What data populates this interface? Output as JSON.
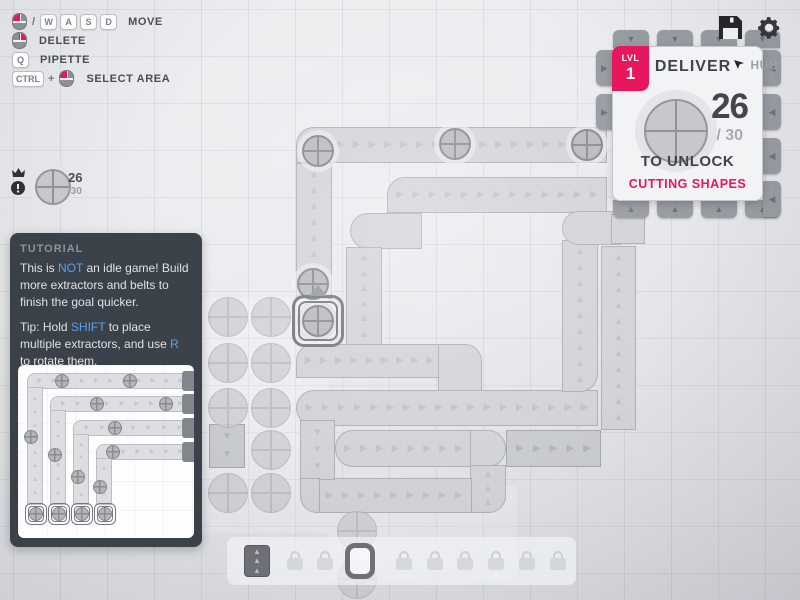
{
  "hud": {
    "keybinds": {
      "row1": {
        "sep": "/",
        "keys": [
          "W",
          "A",
          "S",
          "D"
        ],
        "label": "MOVE"
      },
      "row2": {
        "label": "DELETE"
      },
      "row3": {
        "key": "Q",
        "label": "PIPETTE"
      },
      "row4": {
        "key": "CTRL",
        "plus": "+",
        "label": "SELECT AREA"
      }
    },
    "pinned_goal": {
      "current": "26",
      "total": "/30"
    },
    "icons": [
      "save-icon",
      "gear-icon"
    ]
  },
  "hub": {
    "lvl_label": "LVL",
    "lvl": "1",
    "title": "DELIVER",
    "map_label": "HUB",
    "amount": "26",
    "goal": "/ 30",
    "unlock_line": "TO UNLOCK",
    "reward": "CUTTING SHAPES",
    "accent_color": "#e6175c",
    "shape": "circle"
  },
  "tutorial": {
    "title": "TUTORIAL",
    "p1": [
      {
        "t": "This is "
      },
      {
        "t": "NOT",
        "hl": true
      },
      {
        "t": " an idle game! Build more extractors and belts to finish the goal quicker."
      }
    ],
    "p2": [
      {
        "t": "Tip: Hold "
      },
      {
        "t": "SHIFT",
        "hl": true
      },
      {
        "t": " to place multiple extractors, and use "
      },
      {
        "t": "R",
        "hl": true
      },
      {
        "t": " to rotate them."
      }
    ],
    "diagram": {
      "extractors_x": [
        7,
        30,
        53,
        76
      ],
      "extractor_y": 138,
      "verticals_x": [
        9,
        32,
        55,
        78
      ],
      "horizontals_y": [
        8,
        31,
        55,
        79
      ],
      "belt_right_end": 166,
      "end_blocks_x": 164,
      "items": [
        [
          44,
          16
        ],
        [
          112,
          16
        ],
        [
          79,
          39
        ],
        [
          148,
          39
        ],
        [
          97,
          63
        ],
        [
          95,
          87
        ],
        [
          13,
          72
        ],
        [
          37,
          90
        ],
        [
          60,
          112
        ],
        [
          82,
          122
        ]
      ]
    }
  },
  "toolbar": {
    "slots": [
      {
        "type": "belt",
        "x": 242
      },
      {
        "type": "lock",
        "x": 280
      },
      {
        "type": "lock",
        "x": 310
      },
      {
        "type": "extractor",
        "x": 345,
        "selected": true
      },
      {
        "type": "lock",
        "x": 389
      },
      {
        "type": "lock",
        "x": 420
      },
      {
        "type": "lock",
        "x": 450
      },
      {
        "type": "lock",
        "x": 481
      },
      {
        "type": "lock",
        "x": 512
      },
      {
        "type": "lock",
        "x": 543
      }
    ]
  },
  "scene": {
    "chunks": [
      {
        "x": 188,
        "y": 298,
        "w": 141,
        "h": 235
      },
      {
        "x": 329,
        "y": 486,
        "w": 188,
        "h": 94
      }
    ],
    "belts": [
      {
        "x": 296,
        "y": 127,
        "w": 311,
        "h": 36,
        "dir": "right",
        "r": "18px 0 0 0"
      },
      {
        "x": 296,
        "y": 163,
        "w": 36,
        "h": 136,
        "dir": "up"
      },
      {
        "x": 387,
        "y": 177,
        "w": 220,
        "h": 36,
        "dir": "right",
        "r": "18px 0 0 0"
      },
      {
        "x": 350,
        "y": 213,
        "w": 72,
        "h": 36,
        "dir": "none",
        "r": "18px 0 0 18px"
      },
      {
        "x": 346,
        "y": 247,
        "w": 36,
        "h": 99,
        "dir": "up"
      },
      {
        "x": 296,
        "y": 344,
        "w": 162,
        "h": 34,
        "dir": "right",
        "r": "17px 0 0 0"
      },
      {
        "x": 438,
        "y": 344,
        "w": 44,
        "h": 82,
        "dir": "none",
        "r": "0 17px 17px 0"
      },
      {
        "x": 296,
        "y": 390,
        "w": 302,
        "h": 36,
        "dir": "right",
        "r": "18px 0 0 18px"
      },
      {
        "x": 562,
        "y": 240,
        "w": 36,
        "h": 152,
        "dir": "up",
        "r": "0 0 18px 0"
      },
      {
        "x": 562,
        "y": 211,
        "w": 60,
        "h": 34,
        "dir": "none",
        "r": "17px 0 0 17px"
      },
      {
        "x": 611,
        "y": 214,
        "w": 34,
        "h": 30,
        "dir": "none"
      },
      {
        "x": 601,
        "y": 246,
        "w": 35,
        "h": 184,
        "dir": "up"
      },
      {
        "x": 506,
        "y": 430,
        "w": 95,
        "h": 37,
        "dir": "right",
        "dark": true
      },
      {
        "x": 335,
        "y": 430,
        "w": 137,
        "h": 37,
        "dir": "right",
        "r": "18px 0 0 18px"
      },
      {
        "x": 470,
        "y": 430,
        "w": 36,
        "h": 37,
        "dir": "none",
        "r": "0 18px 18px 0"
      },
      {
        "x": 470,
        "y": 465,
        "w": 36,
        "h": 48,
        "dir": "up",
        "r": "0 0 17px 0"
      },
      {
        "x": 316,
        "y": 478,
        "w": 156,
        "h": 35,
        "dir": "right"
      },
      {
        "x": 300,
        "y": 420,
        "w": 35,
        "h": 60,
        "dir": "down"
      },
      {
        "x": 300,
        "y": 478,
        "w": 20,
        "h": 35,
        "dir": "none",
        "r": "0 0 0 17px"
      },
      {
        "x": 209,
        "y": 424,
        "w": 36,
        "h": 44,
        "dir": "down",
        "dark": true
      }
    ],
    "deposits": [
      [
        228,
        317
      ],
      [
        271,
        317
      ],
      [
        228,
        363
      ],
      [
        271,
        363
      ],
      [
        228,
        408
      ],
      [
        271,
        408
      ],
      [
        271,
        450
      ],
      [
        228,
        493
      ],
      [
        271,
        493
      ],
      [
        317,
        321
      ],
      [
        357,
        531
      ],
      [
        357,
        579
      ]
    ],
    "items": [
      [
        318,
        151
      ],
      [
        455,
        144
      ],
      [
        587,
        145
      ],
      [
        313,
        284
      ],
      [
        318,
        321
      ]
    ],
    "extractor": {
      "x": 292,
      "y": 295,
      "w": 52,
      "h": 52
    },
    "hub_tabs": [
      {
        "x": 613,
        "y": 30,
        "w": 36,
        "h": 18,
        "side": "top"
      },
      {
        "x": 657,
        "y": 30,
        "w": 36,
        "h": 18,
        "side": "top"
      },
      {
        "x": 701,
        "y": 30,
        "w": 36,
        "h": 18,
        "side": "top"
      },
      {
        "x": 745,
        "y": 30,
        "w": 35,
        "h": 18,
        "side": "top"
      },
      {
        "x": 613,
        "y": 200,
        "w": 36,
        "h": 18,
        "side": "bottom"
      },
      {
        "x": 657,
        "y": 200,
        "w": 36,
        "h": 18,
        "side": "bottom"
      },
      {
        "x": 701,
        "y": 200,
        "w": 36,
        "h": 18,
        "side": "bottom"
      },
      {
        "x": 745,
        "y": 200,
        "w": 35,
        "h": 18,
        "side": "bottom"
      },
      {
        "x": 596,
        "y": 50,
        "w": 17,
        "h": 36,
        "side": "left"
      },
      {
        "x": 596,
        "y": 94,
        "w": 17,
        "h": 36,
        "side": "left"
      },
      {
        "x": 763,
        "y": 50,
        "w": 18,
        "h": 36,
        "side": "right"
      },
      {
        "x": 763,
        "y": 94,
        "w": 18,
        "h": 36,
        "side": "right"
      },
      {
        "x": 763,
        "y": 138,
        "w": 18,
        "h": 36,
        "side": "right"
      },
      {
        "x": 763,
        "y": 181,
        "w": 18,
        "h": 36,
        "side": "right"
      }
    ]
  }
}
